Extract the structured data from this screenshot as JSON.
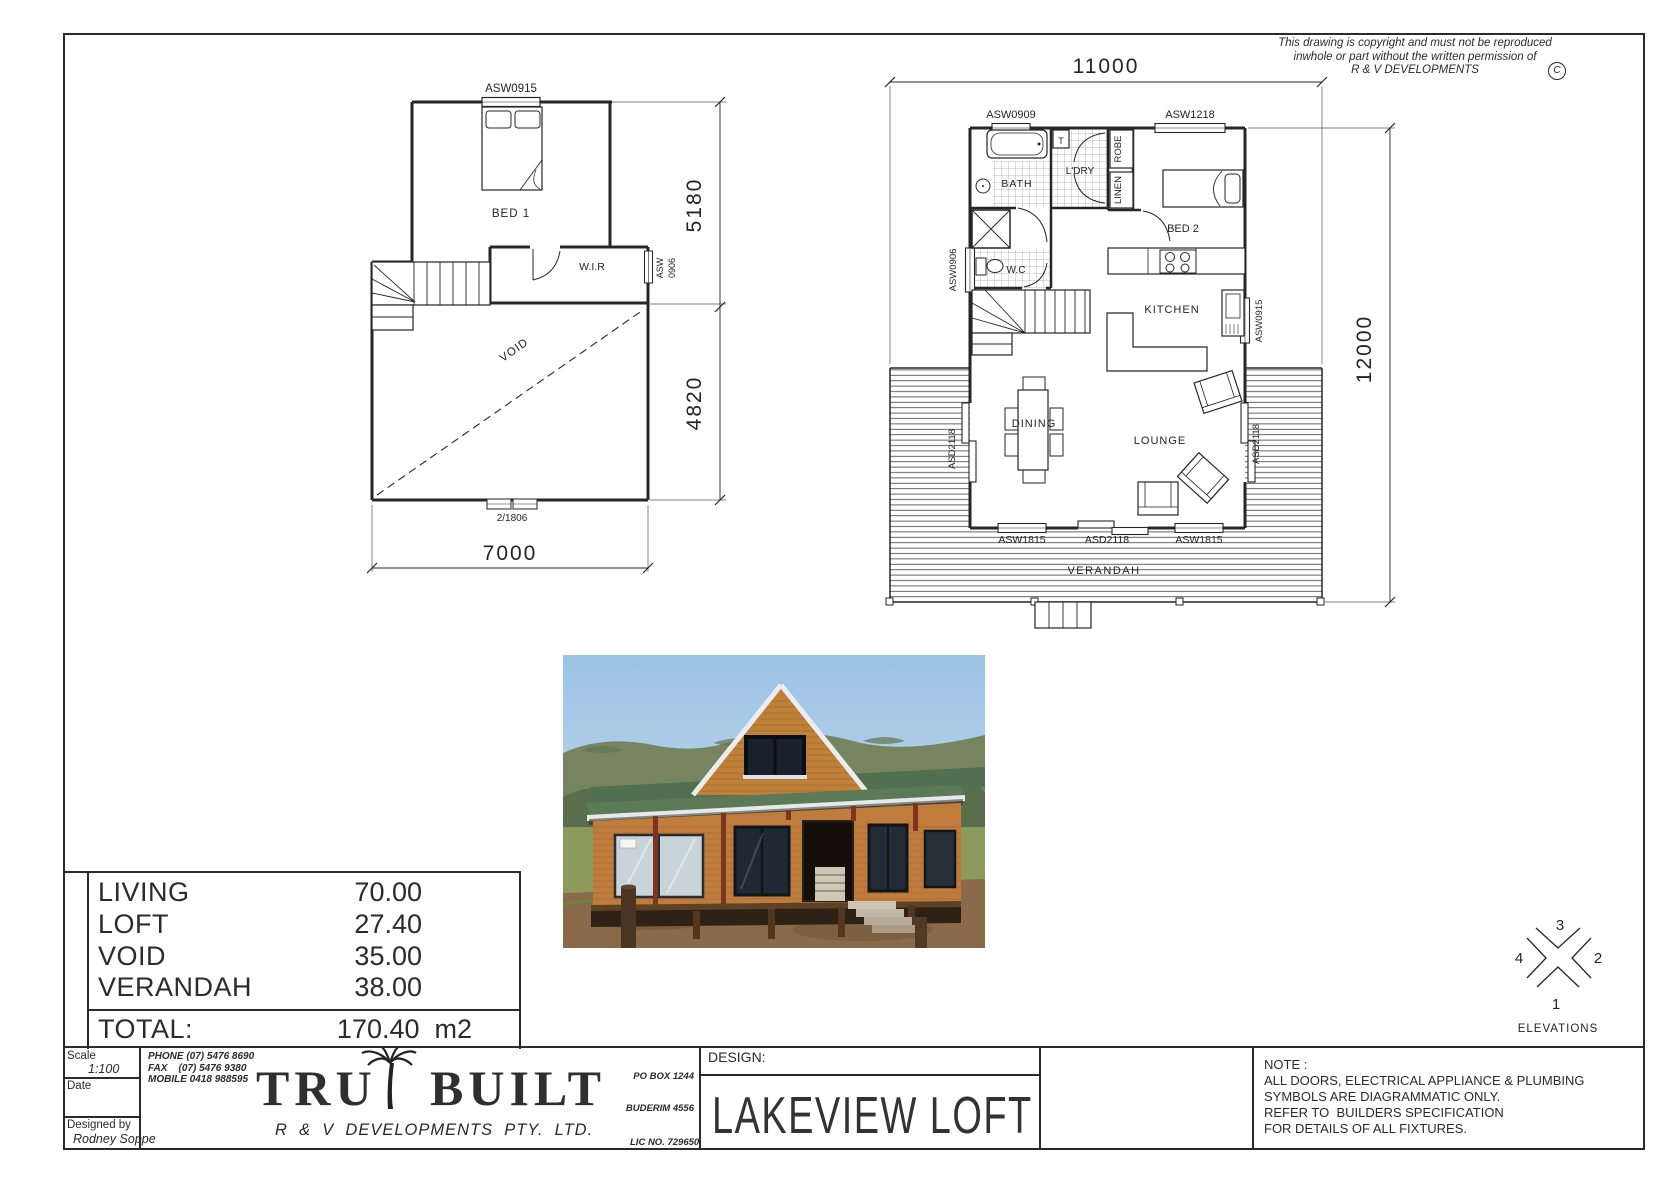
{
  "colors": {
    "ink": "#222222",
    "paper": "#ffffff",
    "photo_sky": "#a9cbe8",
    "photo_roof": "#55704f",
    "photo_timber": "#c07c3a",
    "photo_dirt": "#8a6a4a"
  },
  "copyright": {
    "line1": "This drawing is copyright and must not be reproduced",
    "line2": "inwhole or part without the written permission of",
    "line3": "R & V DEVELOPMENTS",
    "symbol": "C"
  },
  "loft_plan": {
    "window_top": "ASW0915",
    "bed1": "BED 1",
    "wir": "W.I.R",
    "window_right_line1": "ASW",
    "window_right_line2": "0906",
    "void_label": "VOID",
    "door_bottom": "2/1806",
    "dim_width": "7000",
    "dim_upper": "5180",
    "dim_lower": "4820"
  },
  "ground_plan": {
    "dim_width": "11000",
    "dim_height": "12000",
    "window_top_left": "ASW0909",
    "window_top_right": "ASW1218",
    "bath": "BATH",
    "tub": "T",
    "laundry": "L'DRY",
    "robe": "ROBE",
    "linen": "LINEN",
    "bed2": "BED 2",
    "wc": "W.C",
    "kitchen": "KITCHEN",
    "dining": "DINING",
    "lounge": "LOUNGE",
    "verandah": "VERANDAH",
    "window_left": "ASW0906",
    "door_left": "ASD2118",
    "window_right": "ASW0915",
    "door_right": "ASD2118",
    "window_bottom_left": "ASW1815",
    "door_bottom": "ASD2118",
    "window_bottom_right": "ASW1815"
  },
  "area_table": {
    "rows": [
      {
        "label": "LIVING",
        "value": "70.00"
      },
      {
        "label": "LOFT",
        "value": "27.40"
      },
      {
        "label": "VOID",
        "value": "35.00"
      },
      {
        "label": "VERANDAH",
        "value": "38.00"
      }
    ],
    "total_label": "TOTAL:",
    "total_value": "170.40  m2"
  },
  "elevations": {
    "label": "ELEVATIONS",
    "north": "3",
    "east": "2",
    "south": "1",
    "west": "4"
  },
  "title_block": {
    "scale_label": "Scale",
    "scale_value": "1:100",
    "date_label": "Date",
    "designed_label": "Designed by",
    "designer": "Rodney Soppe",
    "phone": "PHONE (07) 5476 8690",
    "fax": "FAX    (07) 5476 9380",
    "mobile": "MOBILE 0418 988595",
    "logo_word1": "TRU",
    "logo_word2": "BUILT",
    "company": "R  &  V  DEVELOPMENTS  PTY.  LTD.",
    "po_box_line1": "PO BOX 1244",
    "po_box_line2": "BUDERIM 4556",
    "lic": "LIC NO. 729650",
    "design_label": "DESIGN:",
    "design_name": "LAKEVIEW LOFT",
    "note_line1": "NOTE :",
    "note_line2": "ALL DOORS, ELECTRICAL APPLIANCE & PLUMBING",
    "note_line3": "SYMBOLS ARE DIAGRAMMATIC ONLY.",
    "note_line4": "REFER TO  BUILDERS SPECIFICATION",
    "note_line5": "FOR DETAILS OF ALL FIXTURES."
  }
}
